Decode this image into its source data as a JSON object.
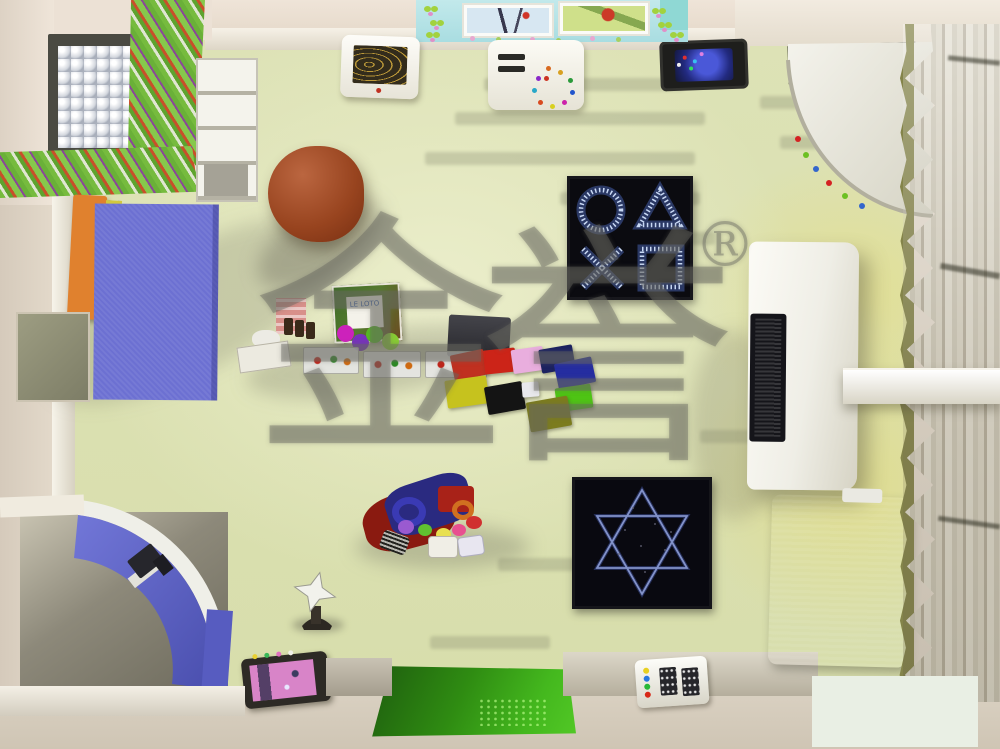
{
  "scene": {
    "description": "Top-down 3D rendering of a children's multi-sensory therapy playroom",
    "render_type": "interior-top-view"
  },
  "watermark": {
    "char_left": "金",
    "char_right": "誉",
    "registered": "®"
  },
  "toys": {
    "book_title": "LE LOTO"
  },
  "icons": {
    "shapes_panel": [
      "circle-icon",
      "triangle-icon",
      "x-icon",
      "square-icon"
    ],
    "star_panel": "six-pointed-star-icon",
    "star_lamp": "four-point-star-icon"
  },
  "palette": {
    "floor": "#dde2b6",
    "wall": "#eae0d4",
    "wall_bottom": "#d6cdbe",
    "curtain": "#d9d4c5",
    "curtain_trim": "#84844a",
    "ball_pool_frame": "#4a4a42",
    "striped_panel_green": "#76bb3e",
    "stripe_red": "#c8502a",
    "shelf_white": "#f4f3ec",
    "book_stack_orange": "#e0812e",
    "book_stack_yellow": "#d2c83c",
    "book_stack_green": "#90bd41",
    "play_mat_blue": "#6c70d2",
    "bean_bag_brown": "#98441f",
    "sensory_panel_black": "#0b0b10",
    "sensory_glow": "#c8d8f4",
    "floor_mats": [
      "#c03020",
      "#cc2418",
      "#e9aede",
      "#1c2260",
      "#252da0",
      "#c6c21e",
      "#141414",
      "#e8e8ec",
      "#4ec414",
      "#7c7c1e"
    ],
    "tv_screen_blue": "#4338d0",
    "cozy_arc_blue": "#5a5fc8",
    "green_mat": "#2f8c12",
    "mattress_blue": "#8393cc",
    "bubble_tube_red": "#cc1830",
    "bubble_tube_green": "#52d97e",
    "tablet_screen_pink": "#d884c8",
    "watermark_gray": "rgba(103,103,95,0.42)"
  }
}
